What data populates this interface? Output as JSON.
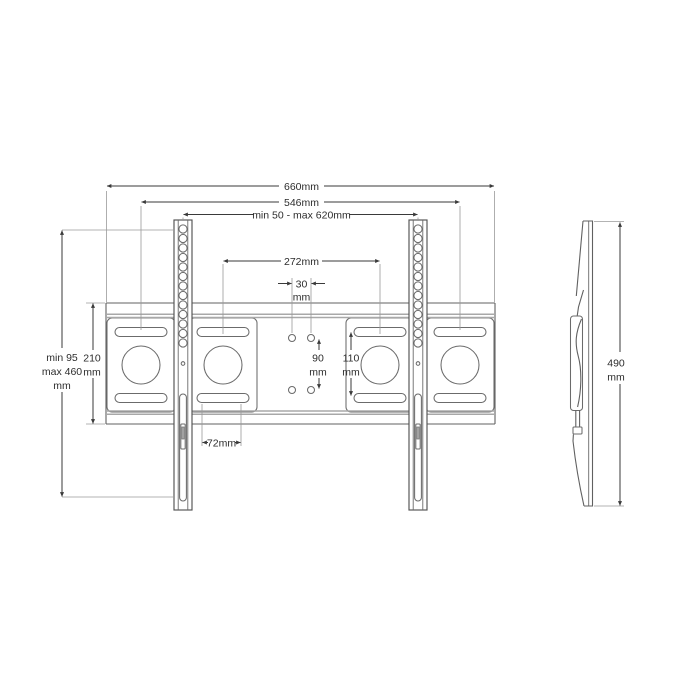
{
  "drawing": {
    "type": "technical-drawing",
    "subject": "TV wall mount bracket dimensional diagram",
    "front": {
      "total_width": "660mm",
      "mount_hole_width": "546mm",
      "adjust_width_range": "min 50 - max 620mm",
      "inner_hole_width": "272mm",
      "center_hole_spacing_value": "30",
      "center_hole_spacing_unit": "mm",
      "center_hole_vertical_value": "90",
      "center_hole_vertical_unit": "mm",
      "slot_vertical_value": "110",
      "slot_vertical_unit": "mm",
      "plate_height_value": "210",
      "plate_height_unit": "mm",
      "height_range_line1": "min 95",
      "height_range_line2": "max 460",
      "height_range_line3": "mm",
      "bottom_slot_width": "72mm"
    },
    "side": {
      "height_value": "490",
      "height_unit": "mm"
    }
  }
}
